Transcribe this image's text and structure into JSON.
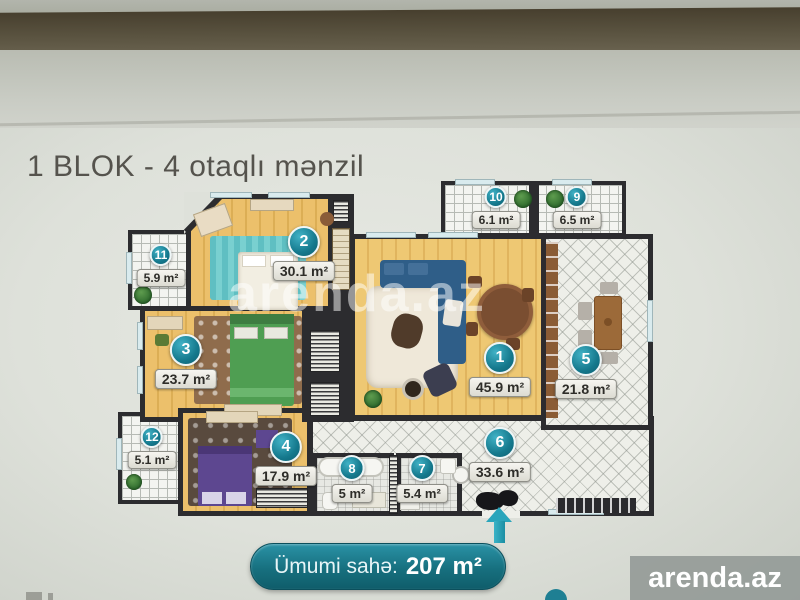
{
  "page": {
    "title": "1 BLOK - 4 otaqlı mənzil"
  },
  "plan": {
    "rooms": [
      {
        "number": "1",
        "area": "45.9 m²"
      },
      {
        "number": "2",
        "area": "30.1 m²"
      },
      {
        "number": "3",
        "area": "23.7 m²"
      },
      {
        "number": "4",
        "area": "17.9 m²"
      },
      {
        "number": "5",
        "area": "21.8 m²"
      },
      {
        "number": "6",
        "area": "33.6 m²"
      },
      {
        "number": "7",
        "area": "5.4 m²"
      },
      {
        "number": "8",
        "area": "5 m²"
      },
      {
        "number": "9",
        "area": "6.5 m²"
      },
      {
        "number": "10",
        "area": "6.1 m²"
      },
      {
        "number": "11",
        "area": "5.9 m²"
      },
      {
        "number": "12",
        "area": "5.1 m²"
      }
    ]
  },
  "total": {
    "label": "Ümumi sahə:",
    "value": "207 m²"
  },
  "watermarks": {
    "center": "arenda.az",
    "corner": "arenda.az"
  },
  "colors": {
    "accent_teal": "#17798d",
    "wall_dark": "#2c2c2f",
    "wood_floor": "#eec873",
    "badge_plate": "#ebeae2",
    "poster": "#dee1da",
    "top_band": "#5a5340"
  }
}
